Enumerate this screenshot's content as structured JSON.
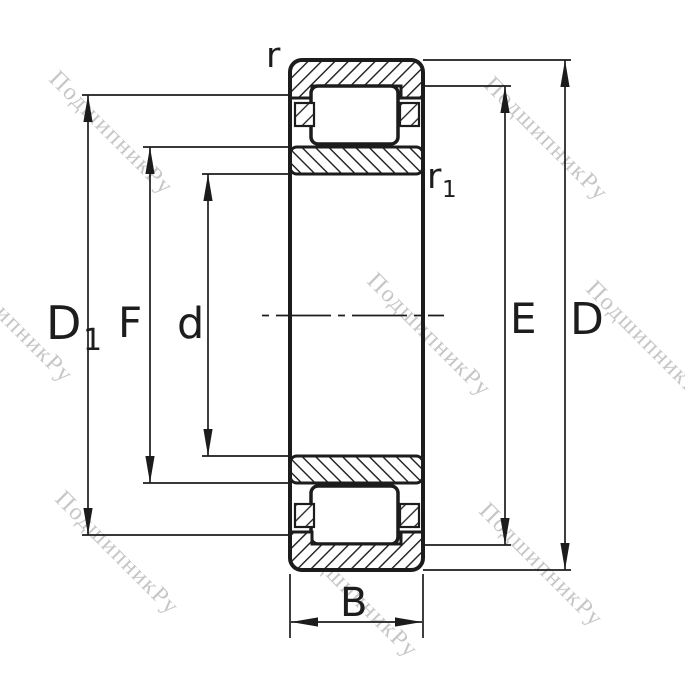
{
  "drawing": {
    "kind": "bearing-cross-section"
  },
  "dimension_labels": {
    "r": "r",
    "r1": {
      "base": "r",
      "sub": "1"
    },
    "D1": {
      "base": "D",
      "sub": "1"
    },
    "F": "F",
    "d": "d",
    "E": "E",
    "D": "D",
    "B": "B"
  },
  "watermark": {
    "text": "ПодшипникРу",
    "color": "#c6c6c6"
  },
  "colors": {
    "line": "#1c1c1c",
    "label": "#1d1d1d",
    "background": "#ffffff"
  }
}
